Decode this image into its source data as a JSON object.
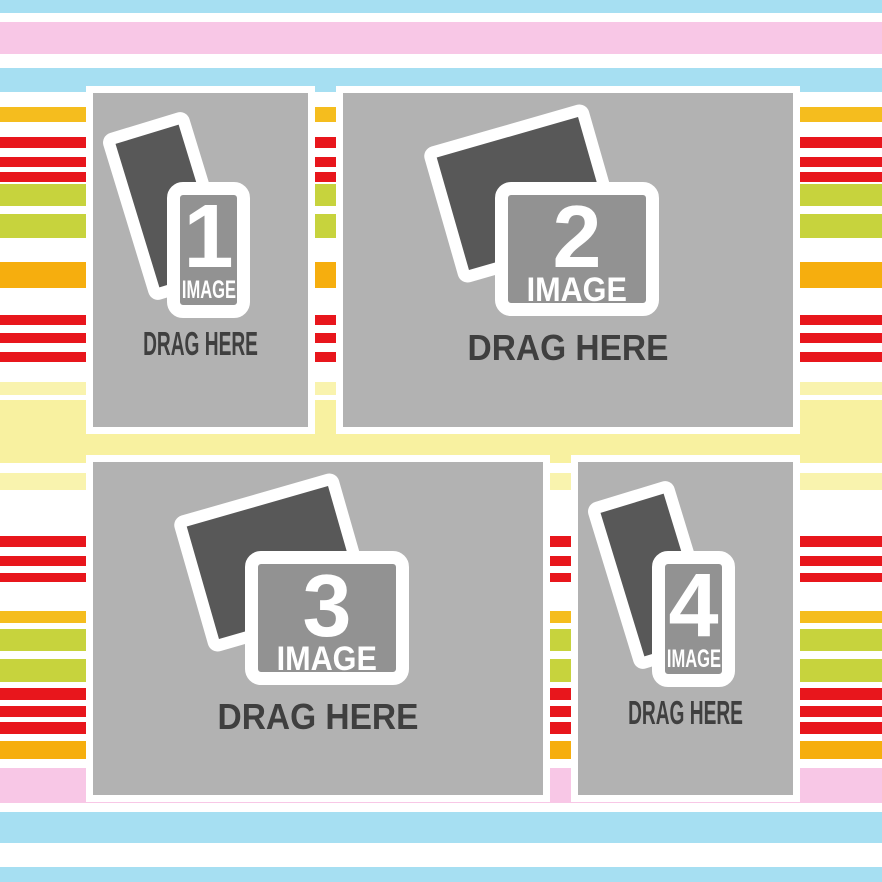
{
  "canvas": {
    "width": 882,
    "height": 882,
    "description": "photo collage drag-and-drop template with striped background"
  },
  "palette": {
    "frame_white": "#ffffff",
    "slot_gray": "#b2b2b2",
    "photo_dark": "#585858",
    "card_gray": "#929292",
    "text_dark": "#3f3f3f",
    "stripe_blue": "#a6dff2",
    "stripe_pink": "#f8c7e6",
    "stripe_gold": "#f5bd1e",
    "stripe_red": "#e8161c",
    "stripe_green": "#c7d33d",
    "stripe_orange": "#f6ae0e",
    "stripe_pale_yellow": "#f9f3ae",
    "stripe_pale_yellow_wide": "#f8f1a0"
  },
  "background": {
    "base": "#ffffff",
    "stripes": [
      {
        "top": 0,
        "height": 13,
        "color": "#a6dff2"
      },
      {
        "top": 22,
        "height": 32,
        "color": "#f8c7e6"
      },
      {
        "top": 68,
        "height": 24,
        "color": "#a6dff2"
      },
      {
        "top": 107,
        "height": 15,
        "color": "#f5bd1e"
      },
      {
        "top": 137,
        "height": 11,
        "color": "#e8161c"
      },
      {
        "top": 157,
        "height": 10,
        "color": "#e8161c"
      },
      {
        "top": 172,
        "height": 10,
        "color": "#e8161c"
      },
      {
        "top": 184,
        "height": 22,
        "color": "#c7d33d"
      },
      {
        "top": 214,
        "height": 24,
        "color": "#c7d33d"
      },
      {
        "top": 262,
        "height": 26,
        "color": "#f6ae0e"
      },
      {
        "top": 315,
        "height": 10,
        "color": "#e8161c"
      },
      {
        "top": 333,
        "height": 10,
        "color": "#e8161c"
      },
      {
        "top": 352,
        "height": 10,
        "color": "#e8161c"
      },
      {
        "top": 382,
        "height": 13,
        "color": "#f9f3ae"
      },
      {
        "top": 400,
        "height": 63,
        "color": "#f8f1a0"
      },
      {
        "top": 473,
        "height": 17,
        "color": "#f9f3ae"
      },
      {
        "top": 536,
        "height": 11,
        "color": "#e8161c"
      },
      {
        "top": 556,
        "height": 10,
        "color": "#e8161c"
      },
      {
        "top": 573,
        "height": 9,
        "color": "#e8161c"
      },
      {
        "top": 611,
        "height": 12,
        "color": "#f5bd1e"
      },
      {
        "top": 629,
        "height": 22,
        "color": "#c7d33d"
      },
      {
        "top": 659,
        "height": 23,
        "color": "#c7d33d"
      },
      {
        "top": 688,
        "height": 12,
        "color": "#e8161c"
      },
      {
        "top": 706,
        "height": 11,
        "color": "#e8161c"
      },
      {
        "top": 722,
        "height": 12,
        "color": "#e8161c"
      },
      {
        "top": 741,
        "height": 18,
        "color": "#f6ae0e"
      },
      {
        "top": 768,
        "height": 35,
        "color": "#f8c7e6"
      },
      {
        "top": 812,
        "height": 31,
        "color": "#a6dff2"
      },
      {
        "top": 867,
        "height": 15,
        "color": "#a6dff2"
      }
    ]
  },
  "slots": [
    {
      "id": 1,
      "number": "1",
      "image_label": "IMAGE",
      "drag_label": "DRAG HERE",
      "orientation": "portrait"
    },
    {
      "id": 2,
      "number": "2",
      "image_label": "IMAGE",
      "drag_label": "DRAG HERE",
      "orientation": "landscape"
    },
    {
      "id": 3,
      "number": "3",
      "image_label": "IMAGE",
      "drag_label": "DRAG HERE",
      "orientation": "landscape"
    },
    {
      "id": 4,
      "number": "4",
      "image_label": "IMAGE",
      "drag_label": "DRAG HERE",
      "orientation": "portrait"
    }
  ]
}
